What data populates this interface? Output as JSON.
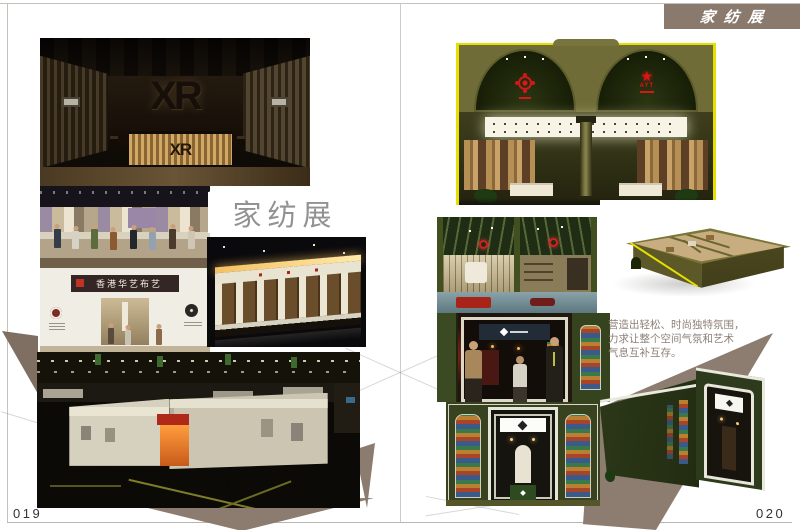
{
  "page": {
    "tab_title": "家纺展",
    "section_label": "家纺展",
    "left_page_number": "019",
    "right_page_number": "020",
    "description_lines": [
      "营造出轻松、时尚独特氛围，",
      "力求让整个空间气氛和艺术",
      "气息互补互存。"
    ]
  },
  "artwork_text": {
    "xr_wall_logo": "XR",
    "xr_desk_logo": "XR",
    "storefront_sign": "香港华艺布艺",
    "arch_star_label": "AYT"
  },
  "icons": {
    "star": "★"
  },
  "colors": {
    "tab_brown": "#8A796D",
    "triangle_taupe": "#8C7C6F",
    "booth_olive": "#6F6C37",
    "trim_yellow": "#E6E000",
    "booth_dark_green": "#333F1E",
    "page_background": "#FFFFFF"
  }
}
